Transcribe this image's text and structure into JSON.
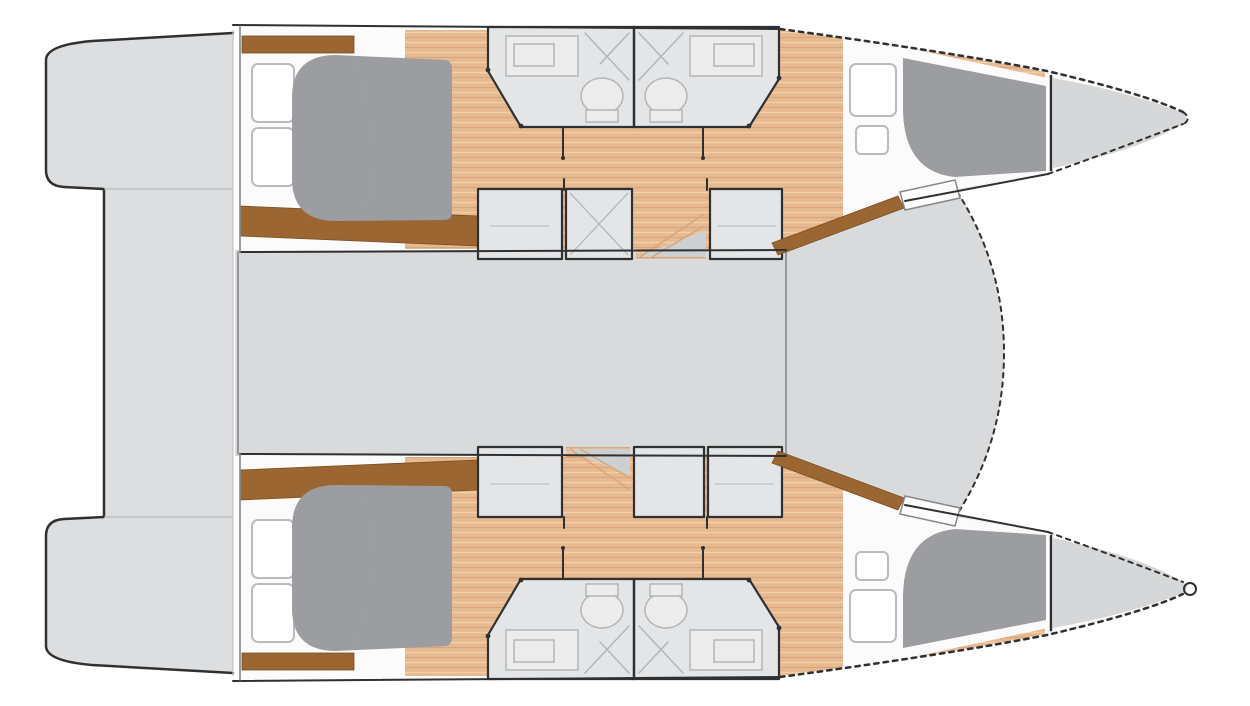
{
  "colors": {
    "background": "#ffffff",
    "outline": "#2e3032",
    "mid_line": "#84888b",
    "light_line": "#b6babc",
    "hull_white": "#fbfbfb",
    "deck_gray": "#d9dadb",
    "platform_gray": "#dddedf",
    "room_gray": "#e4e5e6",
    "bed_gray": "#9b9da0",
    "forepeak_gray": "#d6d7d8",
    "step_gray": "#cdd0d1",
    "wood_base": "#e6b990",
    "wood_stripe": "#f2cfa8",
    "wood_shade": "#d8a67b",
    "wood_accent": "#9b6631",
    "wood_accent_dark": "#7a4e22",
    "window_line": "#b9bcbe",
    "fixture_line": "#b2b6b8",
    "fixture_fill": "#ececed",
    "clothes_line": "#8f9398"
  }
}
